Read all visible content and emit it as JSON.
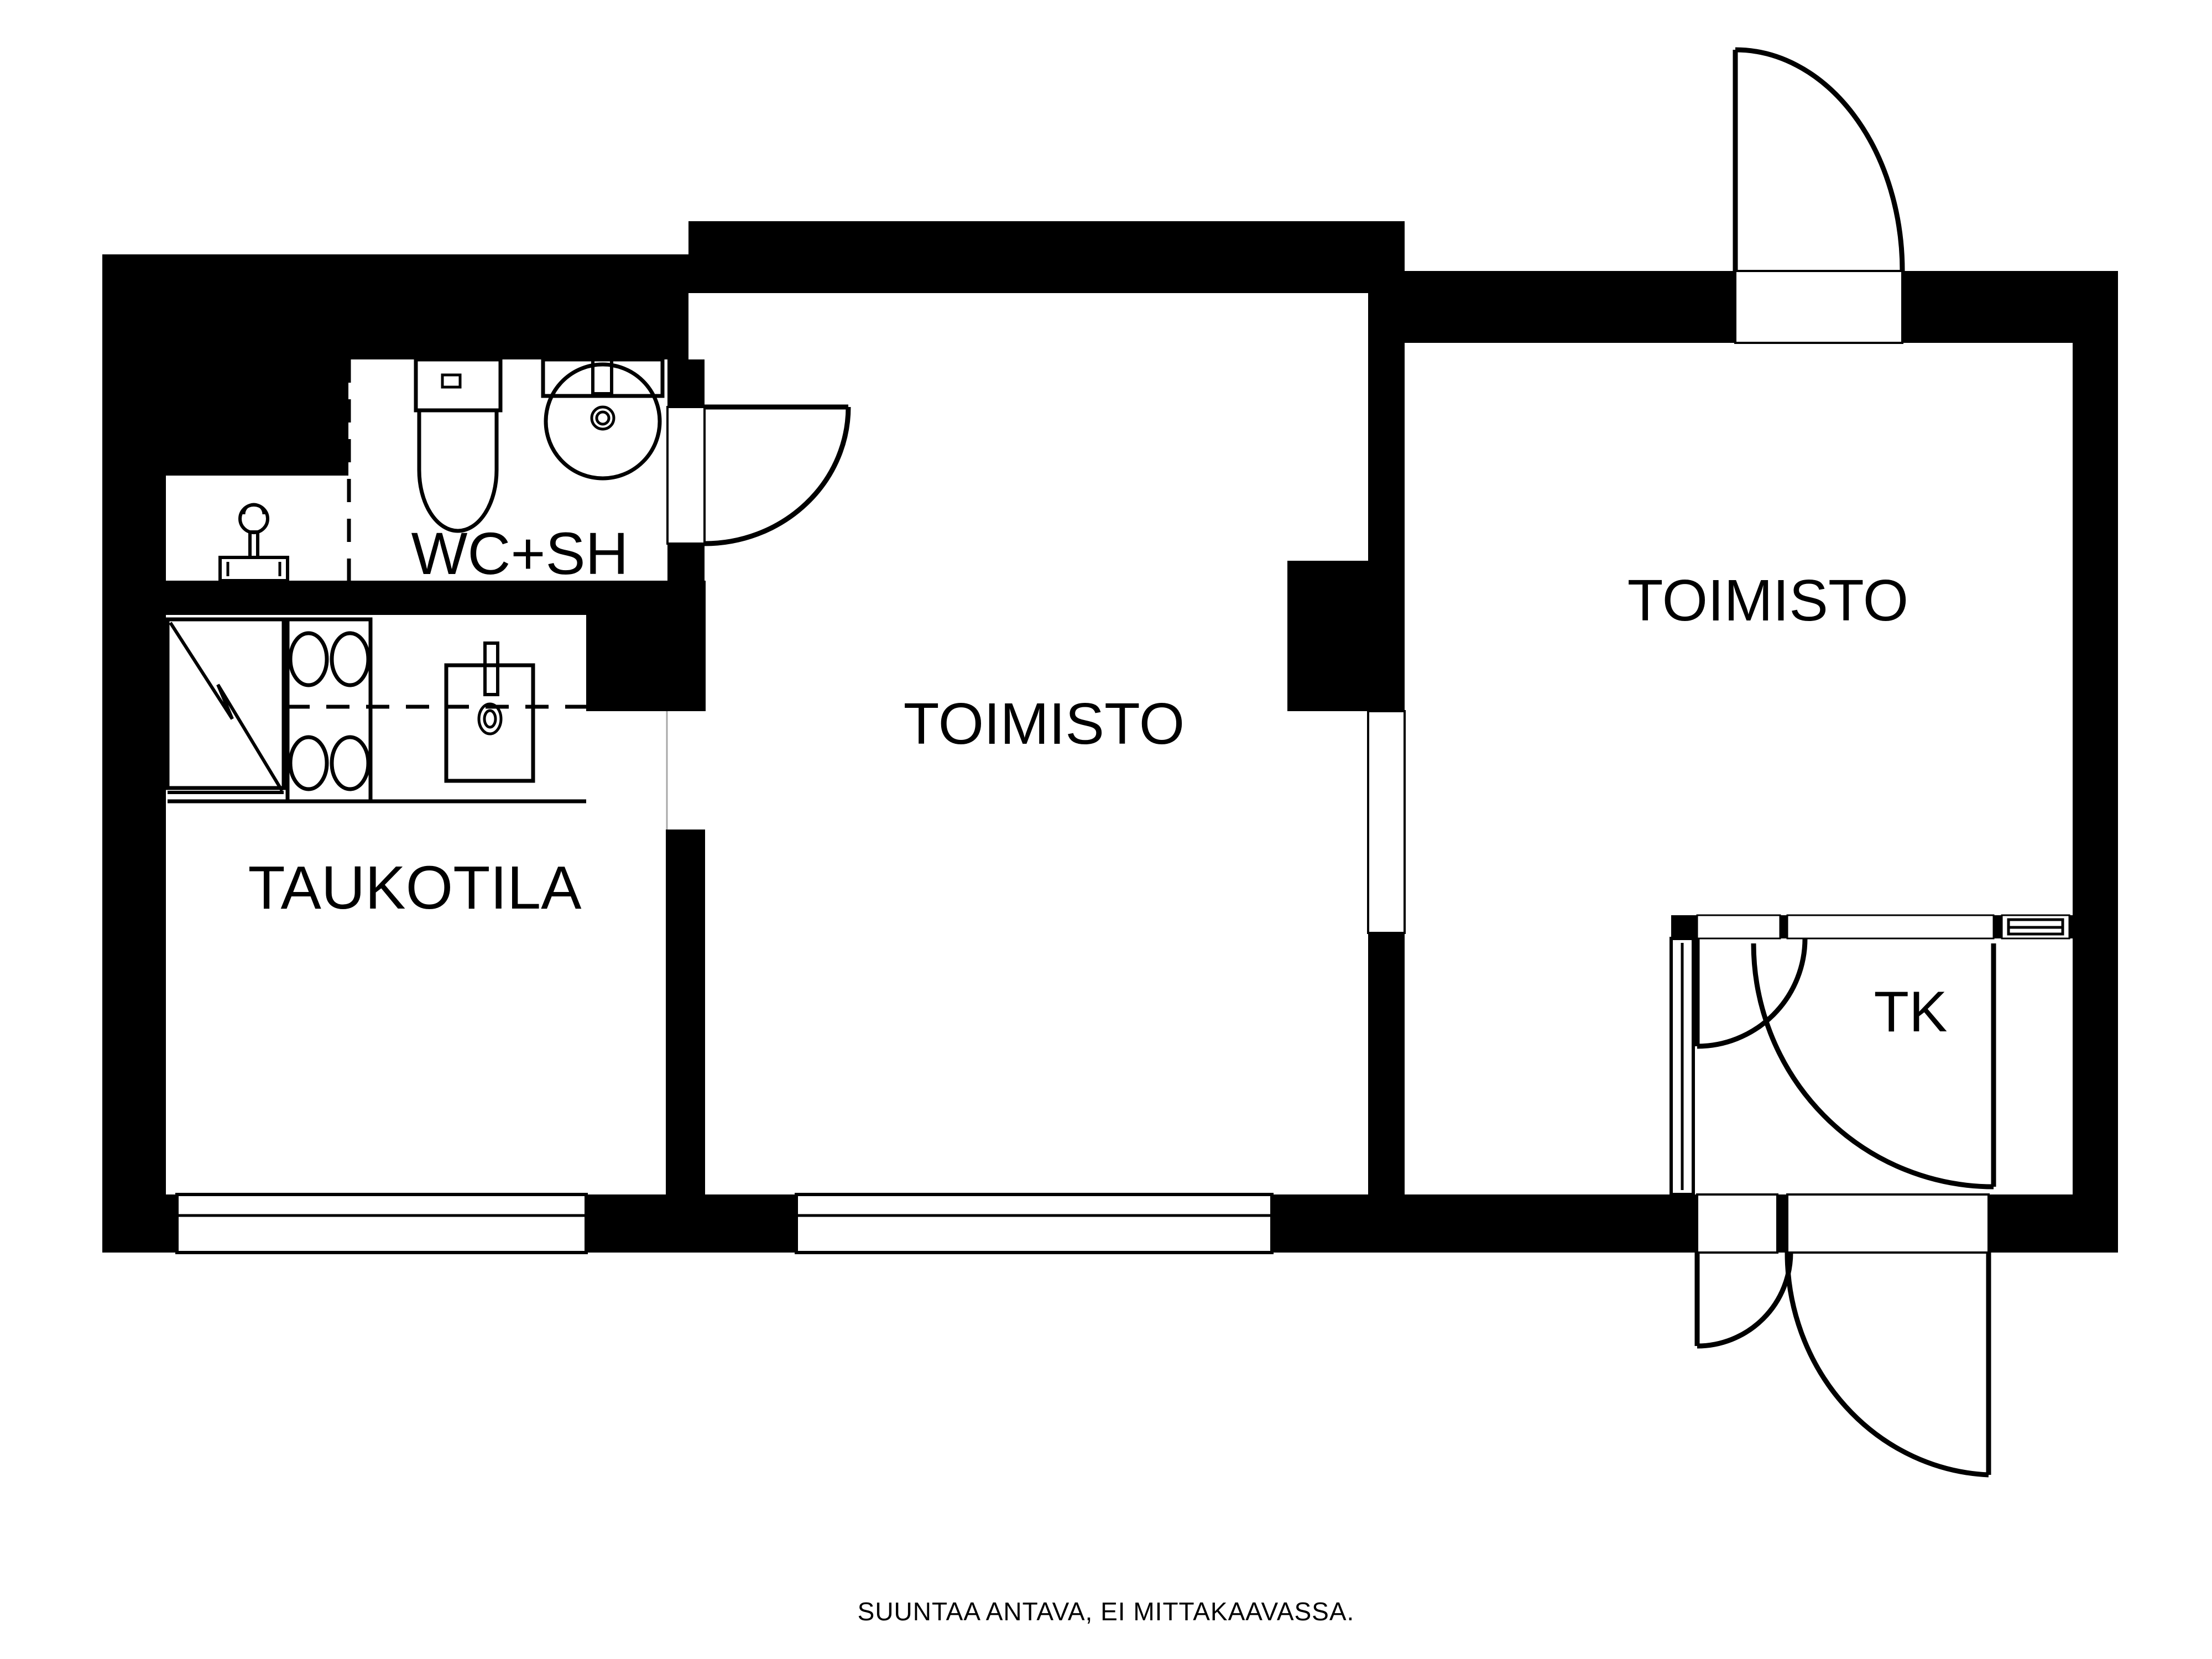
{
  "meta": {
    "type": "floor-plan",
    "language": "fi",
    "background_color": "#ffffff",
    "wall_color": "#000000",
    "line_color": "#000000"
  },
  "rooms": [
    {
      "id": "wc_sh",
      "label": "WC+SH"
    },
    {
      "id": "toimisto_middle",
      "label": "TOIMISTO"
    },
    {
      "id": "toimisto_right",
      "label": "TOIMISTO"
    },
    {
      "id": "taukotila",
      "label": "TAUKOTILA"
    },
    {
      "id": "tk",
      "label": "TK"
    }
  ],
  "caption": "SUUNTAA ANTAVA, EI MITTAKAAVASSA.",
  "icons": [
    "toilet-icon",
    "washbasin-icon",
    "refrigerator-icon",
    "stove-icon",
    "kitchen-sink-icon",
    "water-tap-icon",
    "door-swing-icon",
    "window-icon",
    "sidelight-window-icon"
  ]
}
